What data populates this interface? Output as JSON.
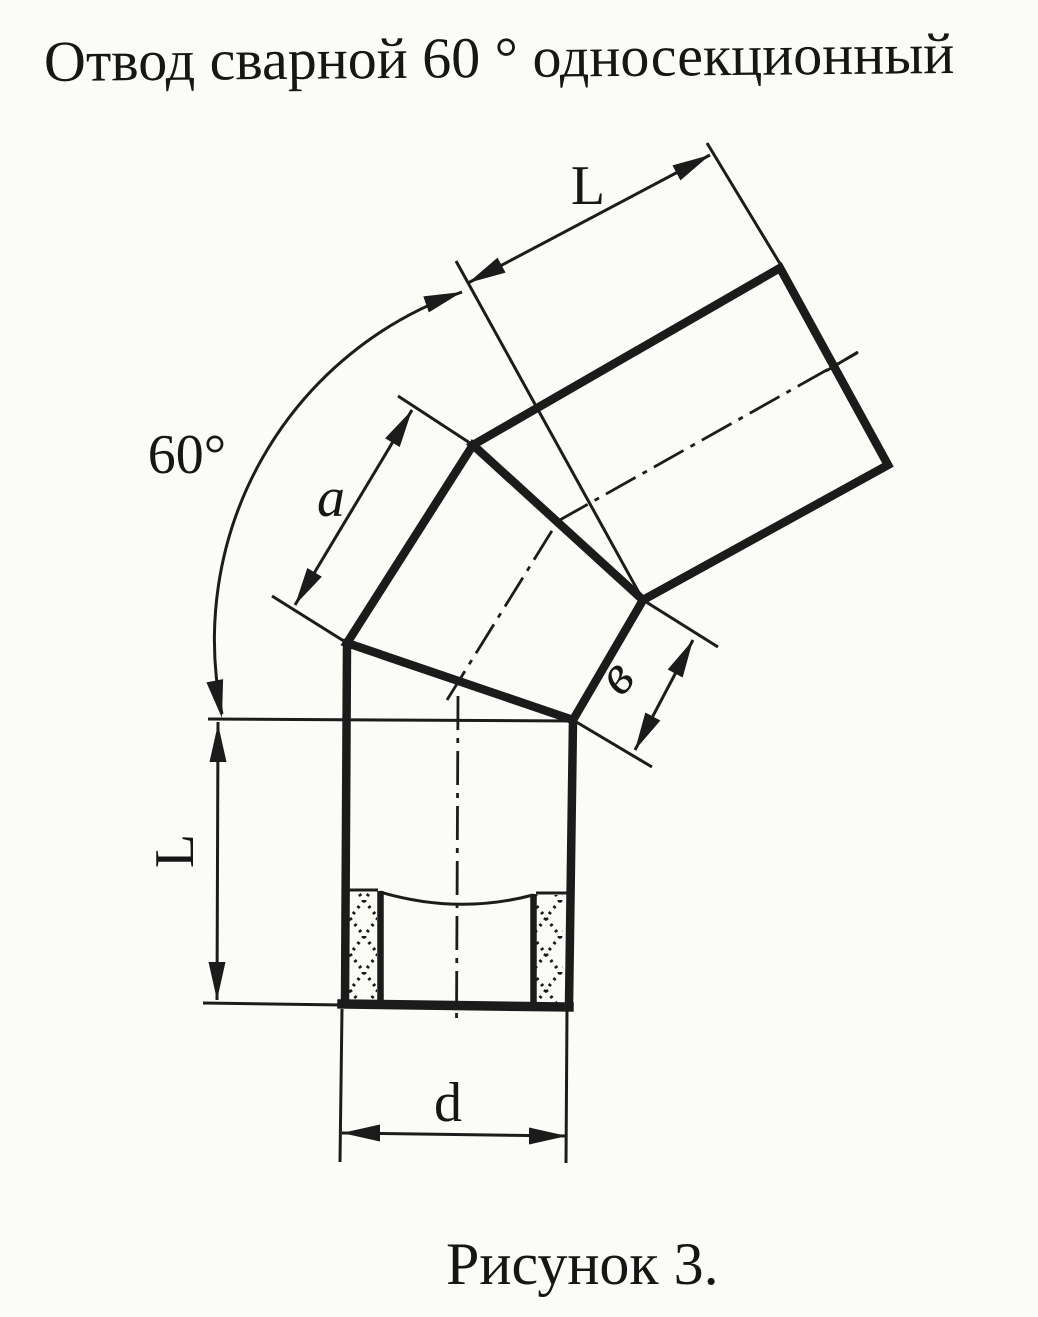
{
  "page": {
    "title": "Отвод сварной 60 ° односекционный",
    "caption": "Рисунок 3."
  },
  "drawing": {
    "angle_label": "60°",
    "dim_labels": {
      "L_top": "L",
      "L_left": "L",
      "a": "a",
      "v": "в",
      "d": "d"
    },
    "ink_color": "#1b1b1b",
    "paper_color": "#fbfbf8"
  }
}
